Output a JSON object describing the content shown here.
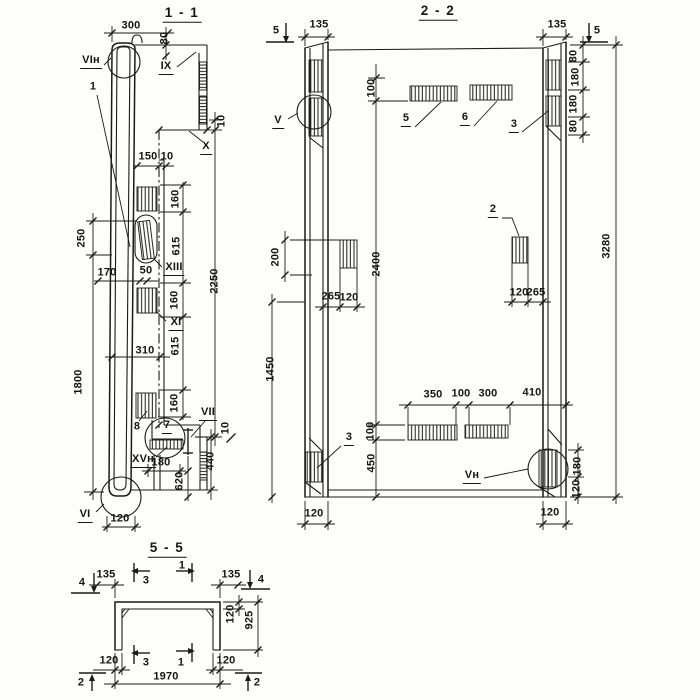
{
  "s11": {
    "title": "1 - 1",
    "marks": {
      "vin": "VIн",
      "ix": "IX",
      "x": "X",
      "xiii": "XIII",
      "xi": "XI",
      "vii": "VII",
      "xvn": "XVн",
      "vi": "VI"
    },
    "items": {
      "i1": "1",
      "i7": "7",
      "i8": "8"
    },
    "dims": {
      "d300": "300",
      "d80": "80",
      "d10a": "10",
      "d150": "150",
      "d10b": "10",
      "d250": "250",
      "d170": "170",
      "d50": "50",
      "d160a": "160",
      "d615a": "615",
      "d160b": "160",
      "d615b": "615",
      "d160c": "160",
      "d2250": "2250",
      "d310": "310",
      "d1800": "1800",
      "d10c": "10",
      "d180": "180",
      "d620": "620",
      "d440": "440",
      "d120": "120"
    }
  },
  "s22": {
    "title": "2 - 2",
    "marks": {
      "v": "V",
      "vn": "Vн"
    },
    "items": {
      "i2": "2",
      "i3a": "3",
      "i3b": "3",
      "i5": "5",
      "i6": "6"
    },
    "cuts": {
      "c5l": "5",
      "c5r": "5"
    },
    "dims": {
      "d135l": "135",
      "d135r": "135",
      "d80a": "80",
      "d180a": "180",
      "d180b": "180",
      "d80b": "80",
      "d3280": "3280",
      "d100a": "100",
      "d200": "200",
      "d2400": "2400",
      "d1450": "1450",
      "d265l": "265",
      "d120l": "120",
      "d120r": "120",
      "d265r": "265",
      "d350": "350",
      "d100b": "100",
      "d300": "300",
      "d410": "410",
      "d100c": "100",
      "d450": "450",
      "d180c": "180",
      "d120c": "120",
      "d120bl": "120",
      "d120br": "120"
    }
  },
  "s55": {
    "title": "5 - 5",
    "cuts": {
      "c4l": "4",
      "c4r": "4",
      "c3t": "3",
      "c1t": "1",
      "c3b": "3",
      "c1b": "1",
      "c2l": "2",
      "c2r": "2"
    },
    "dims": {
      "d135l": "135",
      "d135r": "135",
      "d120t": "120",
      "d925": "925",
      "d120bl": "120",
      "d120br": "120",
      "d1970": "1970"
    }
  }
}
